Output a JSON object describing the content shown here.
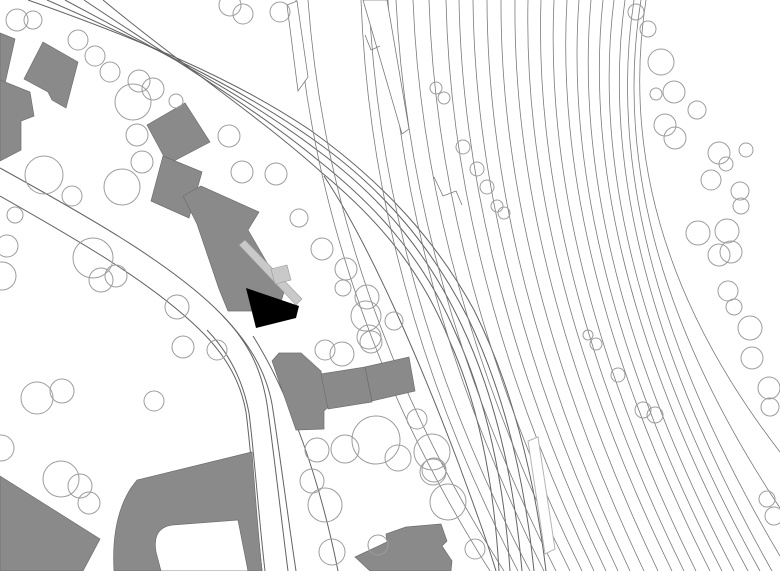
{
  "canvas": {
    "width": 780,
    "height": 571
  },
  "colors": {
    "background": "#ffffff",
    "building_fill": "#8a8a8a",
    "building_stroke": "#6f6f6f",
    "highlight_fill": "#000000",
    "accent_fill": "#c9c9c9",
    "accent_stroke": "#9a9a9a",
    "road_stroke": "#636363",
    "rail_stroke": "#7a7a7a",
    "tree_stroke": "#9d9d9d",
    "platform_stroke": "#b5b5b5"
  },
  "site_plan": {
    "description": "black-and-white architectural site plan: gray building footprints, one black highlighted building, curved road, fanned railway tracks, tree circles",
    "roads": [
      "M 28,0 C 130,36 230,76 310,130 C 386,184 438,244 474,310 C 510,382 534,472 546,571",
      "M 47,0 C 143,42 238,86 314,140 C 388,192 434,252 468,318 C 502,388 524,474 534,571",
      "M 65,0 C 156,49 246,96 317,150 C 388,202 431,260 462,326 C 494,394 514,478 522,571",
      "M 84,0 C 168,57 253,106 319,161 C 386,214 428,268 456,334 C 486,400 504,480 510,571",
      "M 103,0 C 180,64 260,117 321,172 C 384,224 424,276 450,342 C 478,404 494,482 499,571",
      "M 324,176 C 372,248 424,372 458,462 C 472,500 486,538 496,571",
      "M 0,168 C 85,215 165,260 215,308 C 250,342 266,372 272,404 C 279,448 288,518 296,571",
      "M 222,315 C 252,346 262,374 267,404 C 273,446 281,516 288,571",
      "M 0,196 C 78,240 152,283 199,329 C 228,357 241,384 246,412 C 251,450 256,519 262,571",
      "M 207,330 C 233,357 244,386 249,413 C 254,451 259,520 265,571",
      "M 253,336 C 290,395 320,480 338,571"
    ],
    "rails": [
      [
        296,
        318,
        300,
        490,
        571
      ],
      [
        308,
        330,
        298,
        504,
        571
      ],
      [
        361,
        372,
        292,
        518,
        571
      ],
      [
        369,
        382,
        290,
        530,
        571
      ],
      [
        388,
        400,
        286,
        544,
        571
      ],
      [
        396,
        410,
        284,
        556,
        571
      ],
      [
        413,
        424,
        280,
        570,
        571
      ],
      [
        429,
        438,
        278,
        582,
        571
      ],
      [
        446,
        452,
        276,
        594,
        571
      ],
      [
        459,
        464,
        274,
        606,
        571
      ],
      [
        473,
        476,
        272,
        618,
        571
      ],
      [
        487,
        488,
        270,
        630,
        571
      ],
      [
        501,
        500,
        268,
        644,
        571
      ],
      [
        515,
        512,
        266,
        658,
        571
      ],
      [
        528,
        522,
        264,
        672,
        571
      ],
      [
        541,
        532,
        262,
        684,
        571
      ],
      [
        554,
        542,
        260,
        696,
        571
      ],
      [
        567,
        552,
        258,
        710,
        571
      ],
      [
        579,
        560,
        256,
        722,
        571
      ],
      [
        591,
        568,
        254,
        734,
        571
      ],
      [
        603,
        576,
        252,
        748,
        571
      ],
      [
        614,
        582,
        250,
        760,
        571
      ],
      [
        625,
        590,
        248,
        772,
        571
      ],
      [
        634,
        596,
        246,
        780,
        556
      ],
      [
        641,
        602,
        240,
        780,
        508
      ],
      [
        646,
        610,
        232,
        780,
        452
      ]
    ],
    "wedges": [
      "287,5 297,1 308,77 298,91",
      "363,0 387,0 409,129 402,134"
    ],
    "notches": [
      "434,177 443,196 456,191 462,205",
      "365,35 371,50 380,46"
    ],
    "light_platforms": [
      "528,441 538,437 555,549 545,554"
    ],
    "buildings": [
      "0,33 15,39 4,88 0,87",
      "43,42 78,62 66,108 52,100 48,92 24,79",
      "0,80 30,92 34,116 21,121 21,150 0,161",
      "185,103 210,142 168,164 147,125",
      "163,156 202,172 189,218 151,201",
      "183,196 201,186 259,212 248,230 284,292 278,311 228,311 219,289 197,224",
      "272,361 279,353 301,353 321,371 328,407 324,411 324,429 296,430",
      "321,374 365,367 372,402 328,409",
      "365,367 409,357 415,391 372,401",
      "0,476 100,539 83,571 0,571"
    ],
    "building_paths": [
      "M 114,571 Q 111,519 131,488 L 137,480 L 252,452 C 255,492 258,532 262,571 Z M 161,571 L 156,552 Q 152,528 172,525 L 238,520 L 248,571 Z",
      "M 355,557 L 387,542 L 386,534 L 406,527 L 441,524 L 447,541 L 442,546 L 452,561 L 451,571 L 370,571 Z"
    ],
    "accents": [
      "239,245 245,240 302,299 296,305",
      "271,269 287,265 291,280 275,284"
    ],
    "highlight_building": "246,288 299,306 296,318 256,328",
    "trees": [
      [
        17,
        20,
        11
      ],
      [
        33,
        20,
        9
      ],
      [
        78,
        40,
        10
      ],
      [
        95,
        56,
        10
      ],
      [
        110,
        72,
        10
      ],
      [
        139,
        81,
        11
      ],
      [
        153,
        89,
        11
      ],
      [
        133,
        102,
        18
      ],
      [
        176,
        101,
        7
      ],
      [
        137,
        135,
        11
      ],
      [
        142,
        162,
        11
      ],
      [
        44,
        175,
        19
      ],
      [
        122,
        187,
        18
      ],
      [
        72,
        196,
        10
      ],
      [
        15,
        215,
        8
      ],
      [
        7,
        246,
        11
      ],
      [
        2,
        276,
        14
      ],
      [
        93,
        258,
        20
      ],
      [
        101,
        280,
        12
      ],
      [
        116,
        276,
        11
      ],
      [
        177,
        307,
        12
      ],
      [
        183,
        347,
        11
      ],
      [
        217,
        350,
        10
      ],
      [
        230,
        5,
        11
      ],
      [
        243,
        14,
        10
      ],
      [
        280,
        12,
        10
      ],
      [
        229,
        136,
        11
      ],
      [
        242,
        172,
        11
      ],
      [
        276,
        174,
        11
      ],
      [
        299,
        218,
        9
      ],
      [
        322,
        249,
        11
      ],
      [
        346,
        269,
        11
      ],
      [
        343,
        288,
        8
      ],
      [
        367,
        297,
        12
      ],
      [
        366,
        316,
        15
      ],
      [
        394,
        321,
        9
      ],
      [
        371,
        342,
        11
      ],
      [
        325,
        350,
        10
      ],
      [
        342,
        354,
        12
      ],
      [
        369,
        337,
        12
      ],
      [
        417,
        419,
        10
      ],
      [
        398,
        458,
        13
      ],
      [
        317,
        450,
        12
      ],
      [
        434,
        470,
        12
      ],
      [
        376,
        440,
        24
      ],
      [
        345,
        449,
        14
      ],
      [
        432,
        452,
        18
      ],
      [
        448,
        502,
        18
      ],
      [
        433,
        472,
        13
      ],
      [
        37,
        398,
        16
      ],
      [
        62,
        391,
        12
      ],
      [
        154,
        401,
        10
      ],
      [
        61,
        479,
        18
      ],
      [
        80,
        486,
        12
      ],
      [
        89,
        503,
        11
      ],
      [
        1,
        448,
        13
      ],
      [
        312,
        481,
        12
      ],
      [
        325,
        505,
        17
      ],
      [
        332,
        552,
        13
      ],
      [
        475,
        549,
        10
      ],
      [
        378,
        545,
        10
      ],
      [
        636,
        12,
        8
      ],
      [
        648,
        29,
        8
      ],
      [
        661,
        62,
        13
      ],
      [
        674,
        92,
        11
      ],
      [
        656,
        94,
        6
      ],
      [
        697,
        110,
        9
      ],
      [
        665,
        125,
        11
      ],
      [
        675,
        138,
        11
      ],
      [
        719,
        153,
        11
      ],
      [
        726,
        164,
        7
      ],
      [
        746,
        150,
        7
      ],
      [
        711,
        180,
        10
      ],
      [
        740,
        191,
        9
      ],
      [
        698,
        233,
        12
      ],
      [
        727,
        231,
        12
      ],
      [
        719,
        255,
        11
      ],
      [
        731,
        252,
        11
      ],
      [
        728,
        291,
        10
      ],
      [
        734,
        307,
        8
      ],
      [
        750,
        328,
        12
      ],
      [
        752,
        358,
        11
      ],
      [
        769,
        388,
        11
      ],
      [
        741,
        206,
        8
      ],
      [
        643,
        410,
        8
      ],
      [
        655,
        415,
        8
      ],
      [
        770,
        407,
        9
      ],
      [
        767,
        499,
        8
      ],
      [
        774,
        516,
        9
      ],
      [
        436,
        88,
        6
      ],
      [
        444,
        98,
        6
      ],
      [
        463,
        147,
        7
      ],
      [
        477,
        169,
        7
      ],
      [
        487,
        187,
        7
      ],
      [
        497,
        206,
        6
      ],
      [
        504,
        213,
        6
      ],
      [
        588,
        335,
        5
      ],
      [
        596,
        344,
        6
      ],
      [
        618,
        375,
        7
      ]
    ]
  }
}
